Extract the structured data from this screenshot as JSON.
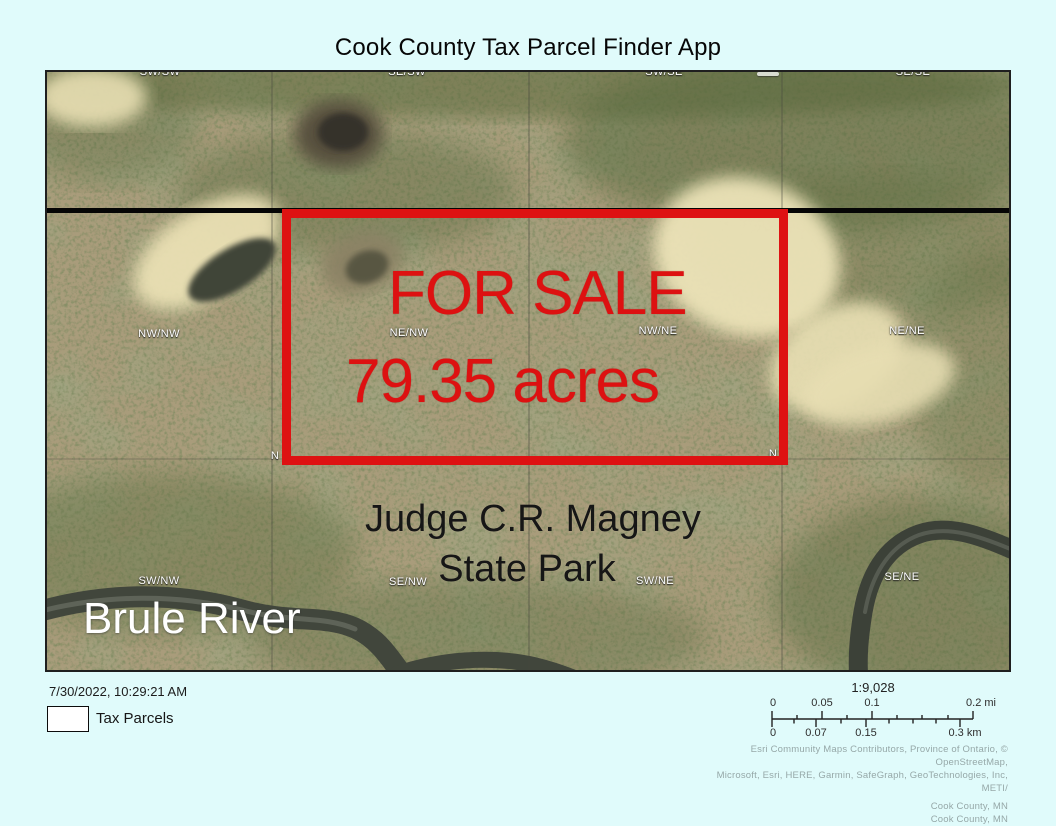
{
  "title": "Cook County Tax Parcel Finder App",
  "map": {
    "for_sale": {
      "line1": "FOR SALE",
      "line2": "79.35 acres"
    },
    "place_labels": {
      "river": "Brule River",
      "park_line1": "Judge C.R. Magney",
      "park_line2": "State Park"
    },
    "parcel_grid_labels": {
      "top_row": [
        "SW/SW",
        "SE/SW",
        "SW/SE",
        "SE/SE"
      ],
      "mid_row": [
        "NW/NW",
        "NE/NW",
        "NW/NE",
        "NE/NE"
      ],
      "bottom_row": [
        "SW/NW",
        "SE/NW",
        "SW/NE",
        "SE/NE"
      ],
      "partial_left": "N",
      "partial_right": "N"
    }
  },
  "footer": {
    "timestamp": "7/30/2022, 10:29:21 AM",
    "legend_label": "Tax Parcels",
    "scale": {
      "ratio": "1:9,028",
      "mi_labels": [
        "0",
        "0.05",
        "0.1",
        "0.2 mi"
      ],
      "km_labels": [
        "0",
        "0.07",
        "0.15",
        "0.3 km"
      ]
    },
    "attribution_line1": "Esri Community Maps Contributors, Province of Ontario, © OpenStreetMap,",
    "attribution_line2": "Microsoft, Esri, HERE, Garmin, SafeGraph, GeoTechnologies, Inc, METI/",
    "attribution_line3": "Cook County, MN",
    "attribution_line4": "Cook County, MN"
  },
  "colors": {
    "page_background": "#e0fbfb",
    "sale_outline_red": "#de1212",
    "sale_text_red": "#dd1111",
    "road_line": "#000000",
    "terrain_base_tan": "#a99c7b",
    "terrain_green": "#55663a",
    "sand_cream": "#ece3b8",
    "river_dark": "#3c4138",
    "label_white": "#ffffff",
    "park_text": "#161616",
    "attribution_gray": "#96a8a8"
  }
}
